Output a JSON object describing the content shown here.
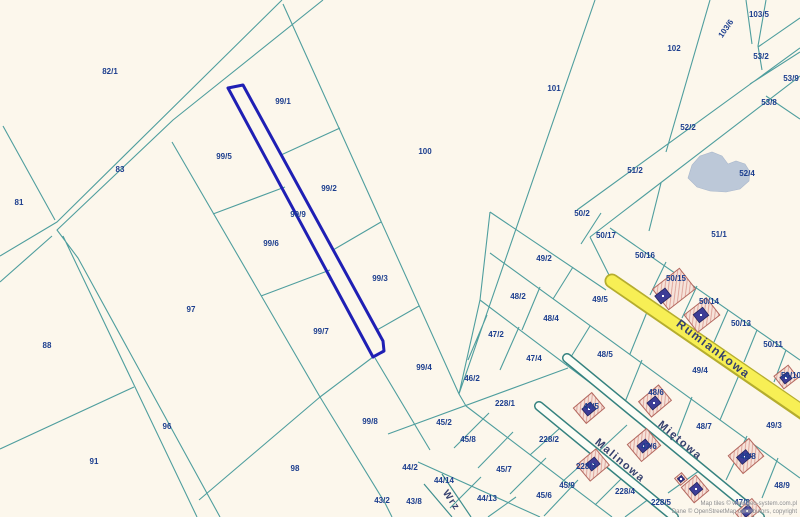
{
  "map": {
    "selected_parcel": {
      "label": "99/9",
      "outline_color": "#1f1fb4"
    },
    "colors": {
      "background": "#fcf7ec",
      "parcel_line": "#4f9e9e",
      "label_text": "#1c3e8e",
      "road_yellow_fill": "#f7ef55",
      "road_yellow_edge": "#b5ad2e",
      "road_white_fill": "#ffffff",
      "water": "#bcc8d8",
      "building_plot": "#f6e3da",
      "building_plot_edge": "#b4685f",
      "building": "#3d3d96"
    },
    "street_labels": [
      {
        "t": "Rumiankowa",
        "x": 711,
        "y": 352,
        "r": 37,
        "sz": 12
      },
      {
        "t": "Miętowa",
        "x": 678,
        "y": 443,
        "r": 40,
        "sz": 11
      },
      {
        "t": "Malinowa",
        "x": 618,
        "y": 463,
        "r": 40,
        "sz": 11
      },
      {
        "t": "Wrz",
        "x": 449,
        "y": 502,
        "r": 55,
        "sz": 10
      }
    ],
    "parcel_labels": [
      {
        "t": "82/1",
        "x": 110,
        "y": 74
      },
      {
        "t": "83",
        "x": 120,
        "y": 172
      },
      {
        "t": "81",
        "x": 19,
        "y": 205
      },
      {
        "t": "88",
        "x": 47,
        "y": 348
      },
      {
        "t": "91",
        "x": 94,
        "y": 464
      },
      {
        "t": "96",
        "x": 167,
        "y": 429
      },
      {
        "t": "97",
        "x": 191,
        "y": 312
      },
      {
        "t": "98",
        "x": 295,
        "y": 471
      },
      {
        "t": "99/1",
        "x": 283,
        "y": 104
      },
      {
        "t": "99/5",
        "x": 224,
        "y": 159
      },
      {
        "t": "99/2",
        "x": 329,
        "y": 191
      },
      {
        "t": "99/6",
        "x": 271,
        "y": 246
      },
      {
        "t": "99/9",
        "x": 298,
        "y": 217
      },
      {
        "t": "99/3",
        "x": 380,
        "y": 281
      },
      {
        "t": "99/7",
        "x": 321,
        "y": 334
      },
      {
        "t": "99/4",
        "x": 424,
        "y": 370
      },
      {
        "t": "99/8",
        "x": 370,
        "y": 424
      },
      {
        "t": "100",
        "x": 425,
        "y": 154
      },
      {
        "t": "101",
        "x": 554,
        "y": 91
      },
      {
        "t": "102",
        "x": 674,
        "y": 51
      },
      {
        "t": "103/5",
        "x": 759,
        "y": 17
      },
      {
        "t": "103/6",
        "x": 728,
        "y": 30,
        "r": -55
      },
      {
        "t": "53/2",
        "x": 761,
        "y": 59
      },
      {
        "t": "53/9",
        "x": 791,
        "y": 81
      },
      {
        "t": "53/8",
        "x": 769,
        "y": 105
      },
      {
        "t": "52/2",
        "x": 688,
        "y": 130
      },
      {
        "t": "51/2",
        "x": 635,
        "y": 173
      },
      {
        "t": "52/4",
        "x": 747,
        "y": 176
      },
      {
        "t": "50/2",
        "x": 582,
        "y": 216
      },
      {
        "t": "50/17",
        "x": 606,
        "y": 238
      },
      {
        "t": "51/1",
        "x": 719,
        "y": 237
      },
      {
        "t": "50/16",
        "x": 645,
        "y": 258
      },
      {
        "t": "49/2",
        "x": 544,
        "y": 261
      },
      {
        "t": "50/15",
        "x": 676,
        "y": 281
      },
      {
        "t": "49/5",
        "x": 600,
        "y": 302
      },
      {
        "t": "50/14",
        "x": 709,
        "y": 304
      },
      {
        "t": "48/2",
        "x": 518,
        "y": 299
      },
      {
        "t": "48/4",
        "x": 551,
        "y": 321
      },
      {
        "t": "50/13",
        "x": 741,
        "y": 326
      },
      {
        "t": "47/2",
        "x": 496,
        "y": 337
      },
      {
        "t": "50/11",
        "x": 773,
        "y": 347
      },
      {
        "t": "48/5",
        "x": 605,
        "y": 357
      },
      {
        "t": "47/4",
        "x": 534,
        "y": 361
      },
      {
        "t": "49/4",
        "x": 700,
        "y": 373
      },
      {
        "t": "46/2",
        "x": 472,
        "y": 381
      },
      {
        "t": "50/10",
        "x": 791,
        "y": 378
      },
      {
        "t": "228/1",
        "x": 505,
        "y": 406
      },
      {
        "t": "47/5",
        "x": 591,
        "y": 409
      },
      {
        "t": "48/6",
        "x": 656,
        "y": 395
      },
      {
        "t": "45/2",
        "x": 444,
        "y": 425
      },
      {
        "t": "48/7",
        "x": 704,
        "y": 429
      },
      {
        "t": "49/3",
        "x": 774,
        "y": 428
      },
      {
        "t": "45/8",
        "x": 468,
        "y": 442
      },
      {
        "t": "228/2",
        "x": 549,
        "y": 442
      },
      {
        "t": "47/6",
        "x": 649,
        "y": 449
      },
      {
        "t": "44/2",
        "x": 410,
        "y": 470
      },
      {
        "t": "45/7",
        "x": 504,
        "y": 472
      },
      {
        "t": "228/3",
        "x": 586,
        "y": 469
      },
      {
        "t": "48/8",
        "x": 748,
        "y": 459
      },
      {
        "t": "44/14",
        "x": 444,
        "y": 483
      },
      {
        "t": "45/9",
        "x": 567,
        "y": 488
      },
      {
        "t": "48/9",
        "x": 782,
        "y": 488
      },
      {
        "t": "43/2",
        "x": 382,
        "y": 503
      },
      {
        "t": "43/8",
        "x": 414,
        "y": 504
      },
      {
        "t": "44/13",
        "x": 487,
        "y": 501
      },
      {
        "t": "45/6",
        "x": 544,
        "y": 498
      },
      {
        "t": "228/4",
        "x": 625,
        "y": 494
      },
      {
        "t": "228/5",
        "x": 661,
        "y": 505
      },
      {
        "t": "47/8",
        "x": 742,
        "y": 505
      }
    ]
  },
  "attribution": {
    "line1": "Map tiles © www.geo-system.com.pl",
    "line2": "Dane © OpenStreetMap contributors, copyright"
  }
}
